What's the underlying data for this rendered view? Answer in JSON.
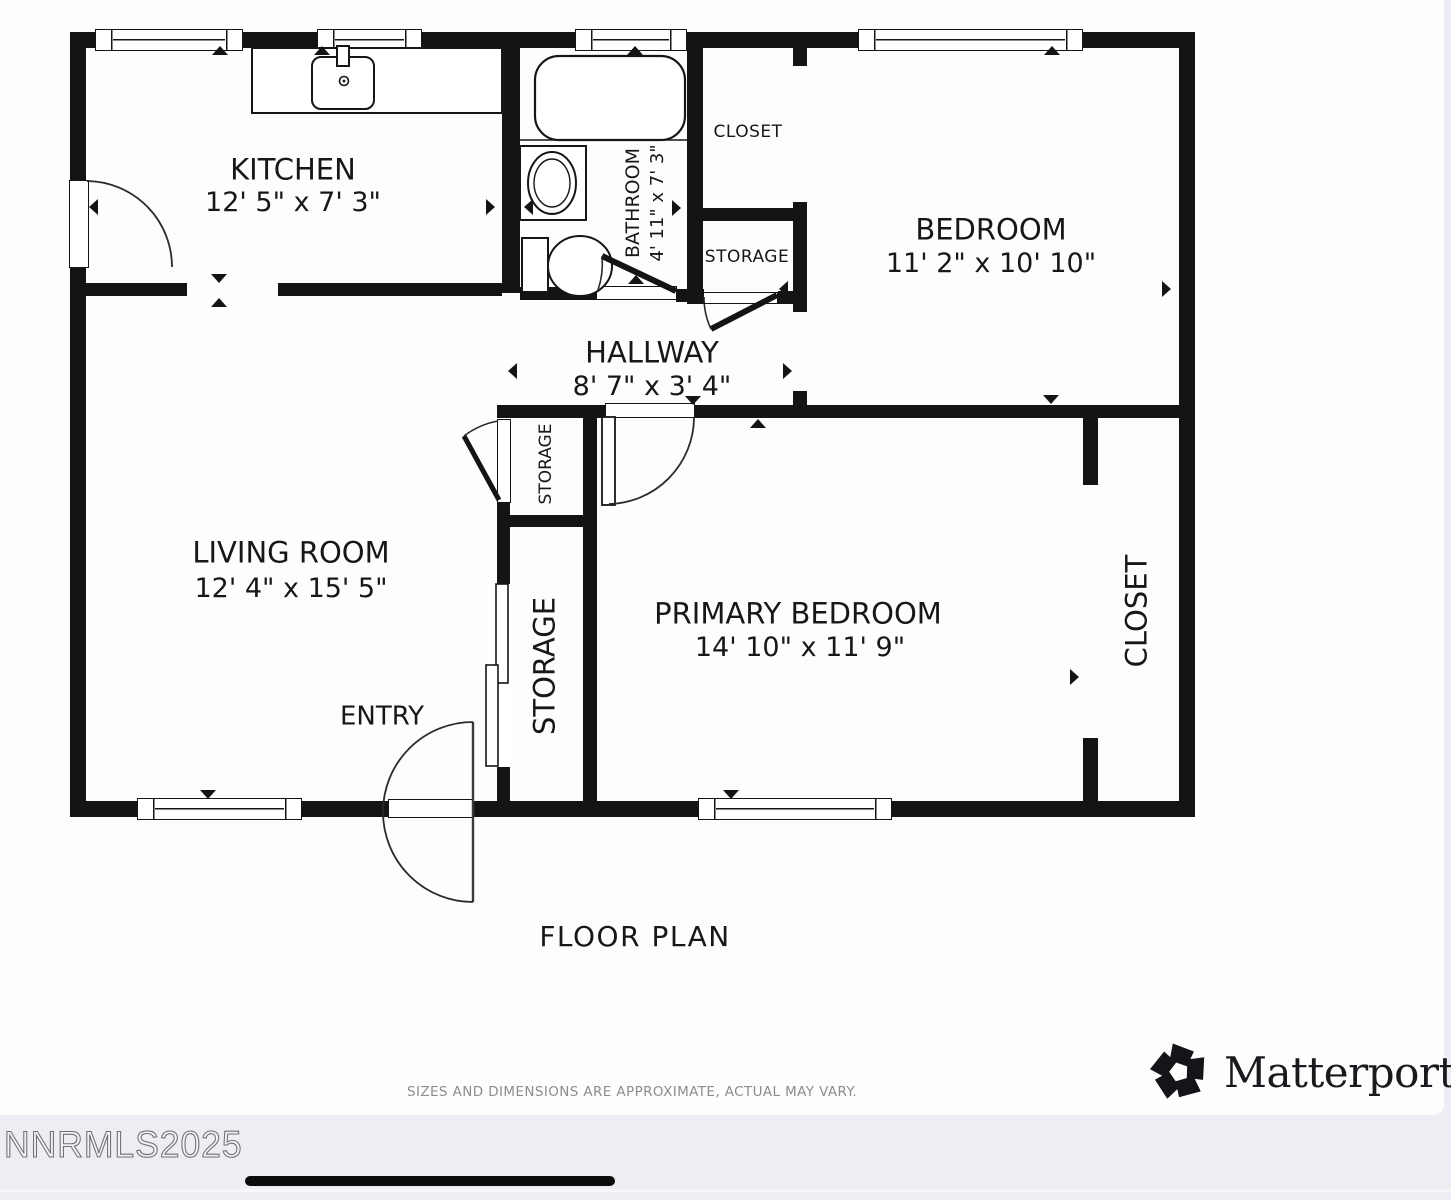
{
  "plan": {
    "title": "FLOOR PLAN",
    "disclaimer": "SIZES AND DIMENSIONS ARE APPROXIMATE, ACTUAL MAY VARY.",
    "watermark": "NNRMLS2025",
    "rooms": {
      "kitchen": {
        "name": "KITCHEN",
        "dims": "12' 5\" x 7' 3\""
      },
      "bathroom": {
        "name": "BATHROOM",
        "dims": "4' 11\" x 7' 3\""
      },
      "closet_top": {
        "name": "CLOSET"
      },
      "storage_top": {
        "name": "STORAGE"
      },
      "bedroom": {
        "name": "BEDROOM",
        "dims": "11' 2\" x 10' 10\""
      },
      "hallway": {
        "name": "HALLWAY",
        "dims": "8' 7\" x 3' 4\""
      },
      "living_room": {
        "name": "LIVING ROOM",
        "dims": "12' 4\" x 15' 5\""
      },
      "storage_small": {
        "name": "STORAGE"
      },
      "storage_tall": {
        "name": "STORAGE"
      },
      "primary_bedroom": {
        "name": "PRIMARY BEDROOM",
        "dims": "14' 10\" x 11' 9\""
      },
      "closet_right": {
        "name": "CLOSET"
      },
      "entry": {
        "name": "ENTRY"
      }
    }
  },
  "brand": {
    "name": "Matterport",
    "registered": "®"
  },
  "colors": {
    "wall": "#141414",
    "ink": "#171717",
    "muted": "#8d8d8d",
    "paper": "#fdfdfe",
    "footer_bg": "#ededf3"
  }
}
